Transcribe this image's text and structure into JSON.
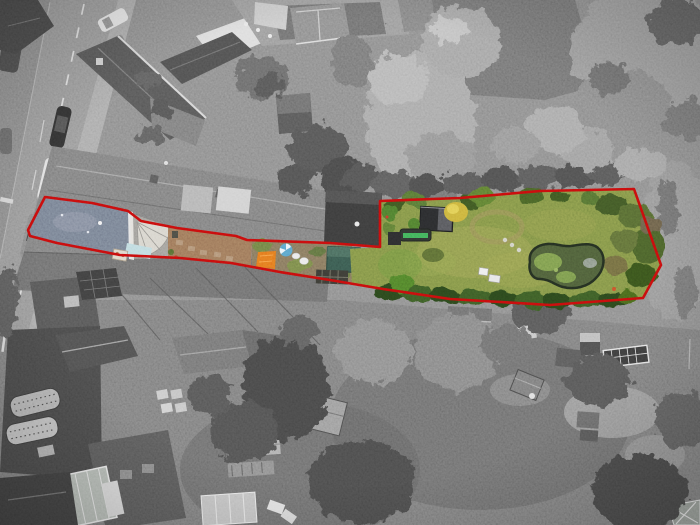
{
  "meta": {
    "media": "aerial-drone-photograph",
    "style": "surroundings desaturated to monochrome; outlined property plot shown in colour",
    "width": 700,
    "height": 525,
    "visible_text": "none"
  },
  "colors": {
    "boundary_red": "#c40d0d",
    "mono_base": "#8c8c8c",
    "lawn_green": "#7f9146",
    "lawn_light": "#a2a357",
    "lawn_bright": "#6f9440",
    "hedge_green": "#2c451d",
    "shrub_green": "#3f5627",
    "bush_yellow": "#c9b03b",
    "pond_water": "#4c5c38",
    "pond_algae": "#7fa04f",
    "pond_rim": "#232d20",
    "garden_shed_dark": "#2a2b2d",
    "shed_teal": "#39584e",
    "tarp_orange": "#e2761f",
    "pool_blue": "#57a0c8",
    "trampoline_green": "#3fae57",
    "patio_tan": "#9b7558",
    "dirt_brown": "#83755c",
    "roof_slate_blue": "#757e90",
    "conservatory_glass": "#bcd9de",
    "chimney_cream": "#ddd6c8"
  },
  "boundary": {
    "points": "45,197 92,203 128,211 141,221 177,228 236,236 247,240 330,243 380,247 380,201 460,198 540,191 634,189 661,265 643,298 550,305 450,299 383,289 330,280 280,272 231,263 180,258 120,255 57,243 30,236 28,230",
    "stroke_width": 2.6
  },
  "plot": {
    "lawn_points": "380,201 460,198 540,191 634,189 661,265 643,298 550,305 450,299 383,289 352,284 350,249 380,247",
    "roof_points": "45,197 92,203 129,212 130,259 120,255 57,243 30,236 28,230",
    "conservatory_points": "130,213 168,226 168,258 131,259",
    "patio_points": "168,226 240,237 252,241 251,268 231,263 181,258 168,257",
    "dirt_points": "252,241 330,243 352,246 352,284 330,280 280,272 252,268"
  }
}
